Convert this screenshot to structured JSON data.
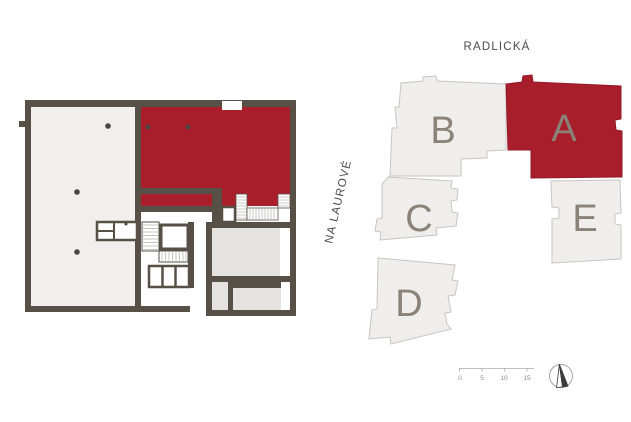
{
  "streets": {
    "top": "RADLICKÁ",
    "left": "NA LAUROVÉ"
  },
  "site_plan": {
    "buildings": [
      {
        "id": "A",
        "label": "A",
        "highlighted": true
      },
      {
        "id": "B",
        "label": "B",
        "highlighted": false
      },
      {
        "id": "C",
        "label": "C",
        "highlighted": false
      },
      {
        "id": "D",
        "label": "D",
        "highlighted": false
      },
      {
        "id": "E",
        "label": "E",
        "highlighted": false
      }
    ],
    "highlighted_building": "A"
  },
  "floor_plan": {
    "highlighted_unit_color": "#a81e2b"
  },
  "scale_bar": {
    "ticks": [
      "0",
      "5",
      "10",
      "15"
    ]
  },
  "compass": {
    "direction": "N"
  },
  "colors": {
    "highlight": "#a81e2b",
    "wall": "#575046",
    "building_fill": "#efeeec",
    "building_outline": "#c9c5be",
    "room_fill_light": "#f0efed",
    "room_fill_gray": "#e4e3e0",
    "building_label": "#8b8377",
    "street_text": "#4a4a4a"
  }
}
